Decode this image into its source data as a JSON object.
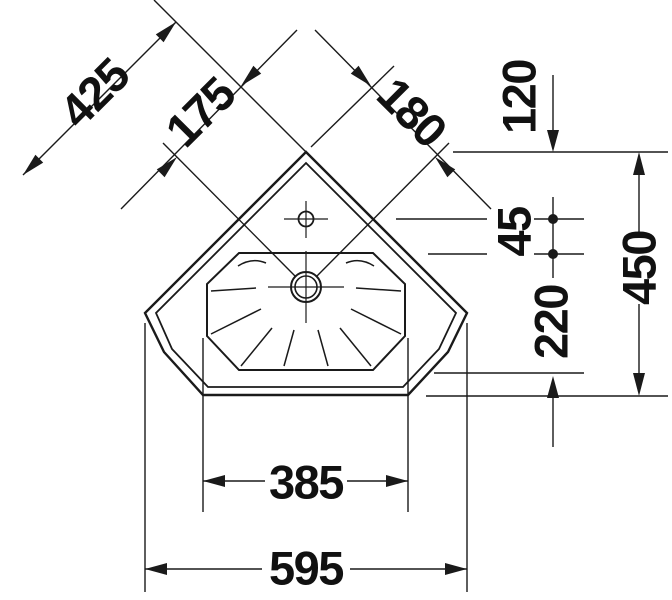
{
  "drawing": {
    "labels": {
      "wall_edge": "425",
      "left_axis": "175",
      "right_axis": "180",
      "tip_to_hole": "120",
      "hole_gap": "45",
      "hole_to_front": "220",
      "depth": "450",
      "front_edge": "385",
      "width": "595"
    },
    "colors": {
      "line": "#1a1a1a",
      "text": "#111111",
      "background": "#ffffff"
    }
  }
}
